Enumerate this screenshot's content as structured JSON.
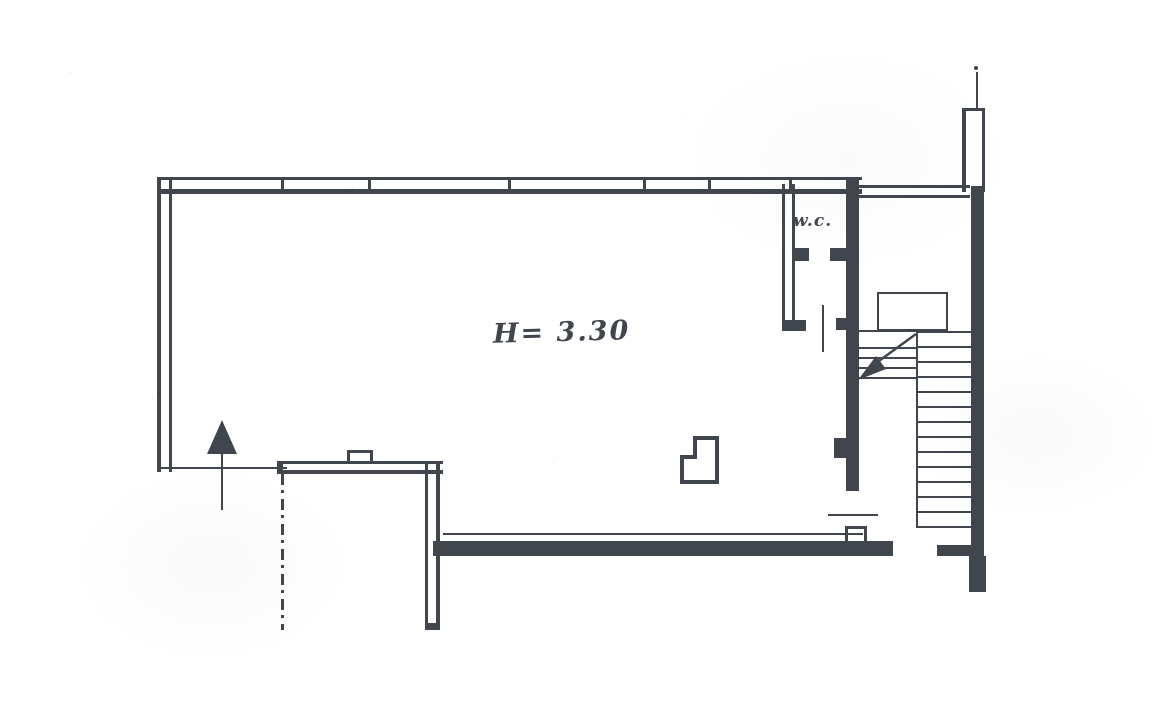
{
  "labels": {
    "room_height": "H= 3.30",
    "wc": "w.c."
  },
  "colors": {
    "ink": "#41454e",
    "paper": "#ffffff"
  },
  "icons": {
    "entrance_arrow": "up-arrow-icon",
    "stair_direction_arrow": "down-left-arrow-icon"
  }
}
